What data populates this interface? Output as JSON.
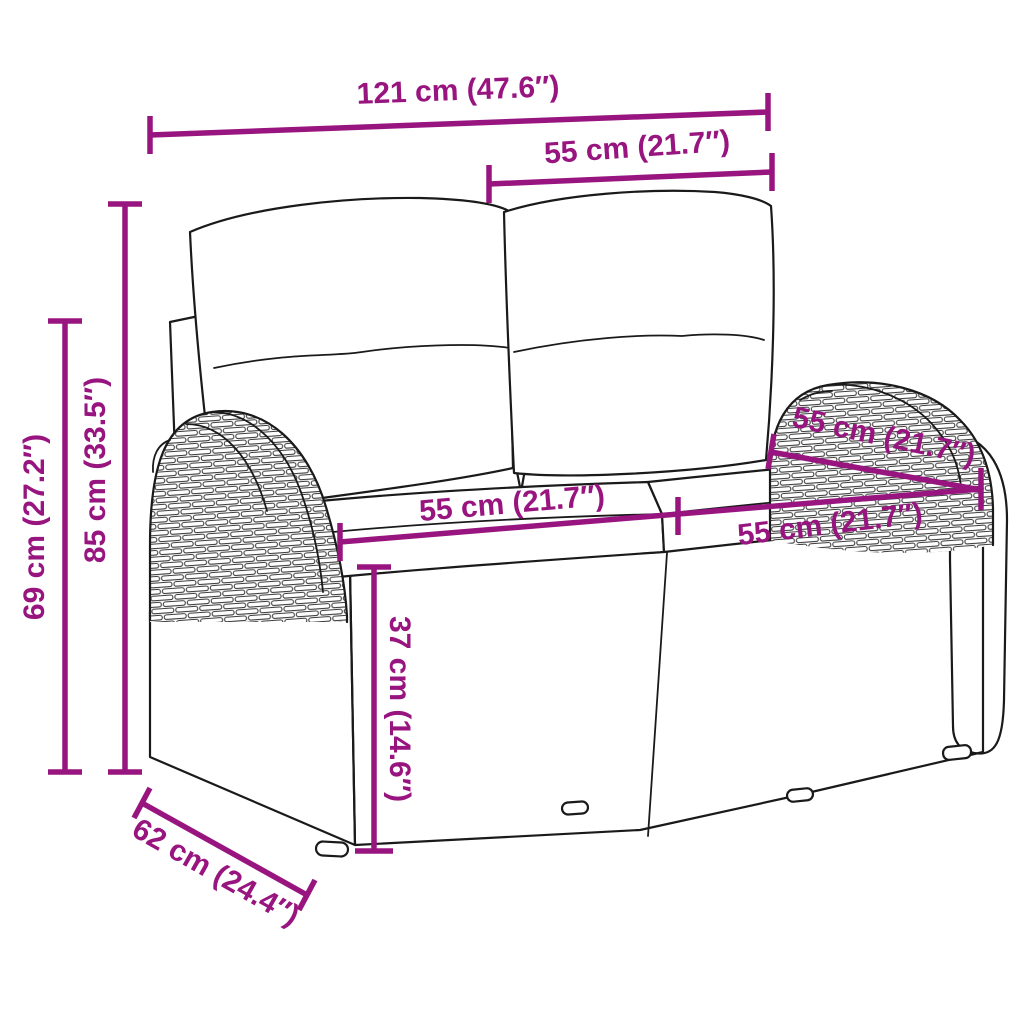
{
  "diagram": {
    "subject": "two-seater poly rattan garden sofa with back and seat cushions",
    "background_color": "#ffffff",
    "accent_color": "#981580",
    "outline_color": "#1a1a1a",
    "dimensions": {
      "overall_width": "121 cm (47.6″)",
      "backrest_width": "55 cm (21.7″)",
      "height_total": "85 cm (33.5″)",
      "height_secondary": "69 cm (27.2″)",
      "depth_total": "62 cm (24.4″)",
      "seat_width_left": "55 cm (21.7″)",
      "seat_width_right": "55 cm (21.7″)",
      "seat_depth_diagonal": "55 cm (21.7″)",
      "seat_height": "37 cm (14.6″)"
    }
  }
}
